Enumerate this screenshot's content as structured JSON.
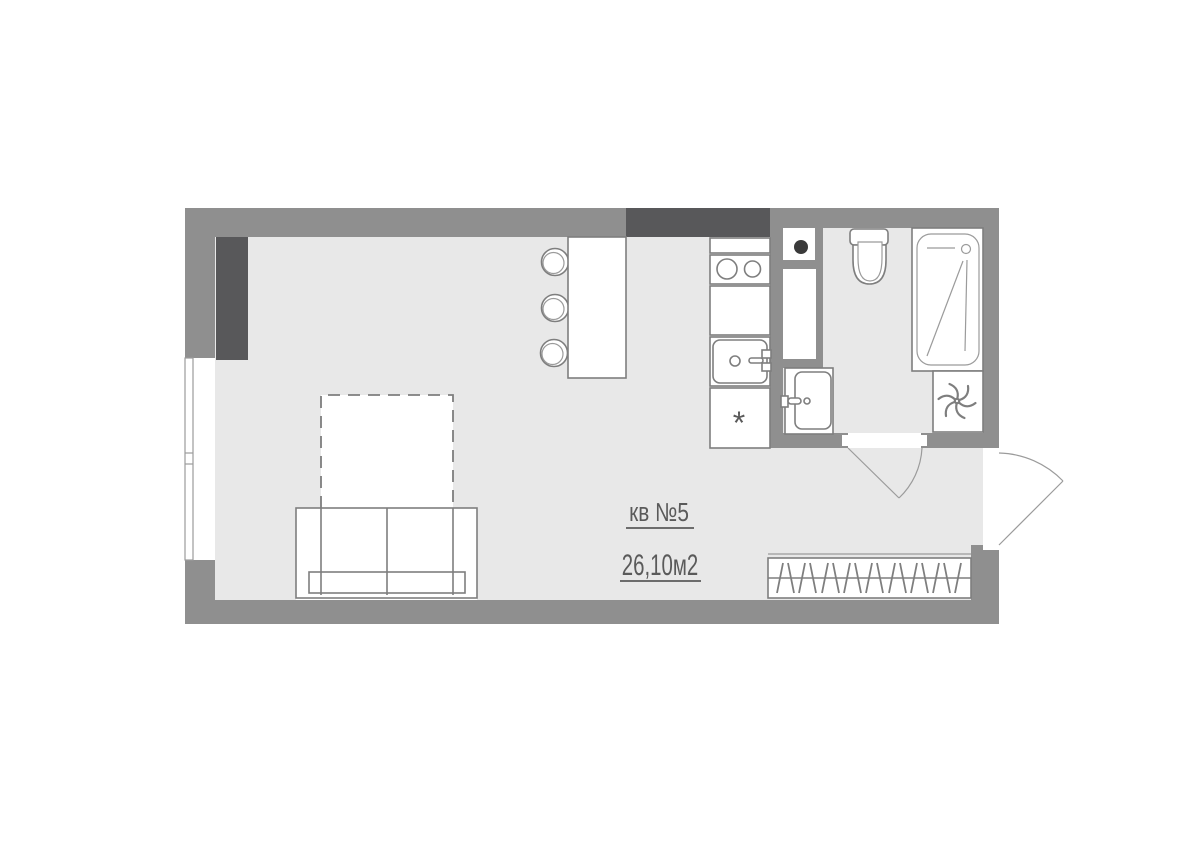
{
  "palette": {
    "bg": "#ffffff",
    "wall": "#8f8f8f",
    "wall_dark": "#58585a",
    "floor": "#e8e8e8",
    "line": "#7e7e7e",
    "line_soft": "#9b9b9b",
    "text": "#5a5a5a",
    "dot": "#3a3a3a"
  },
  "labels": {
    "apartment_number": "кв №5",
    "area": "26,10м2",
    "fridge_symbol": "*"
  }
}
